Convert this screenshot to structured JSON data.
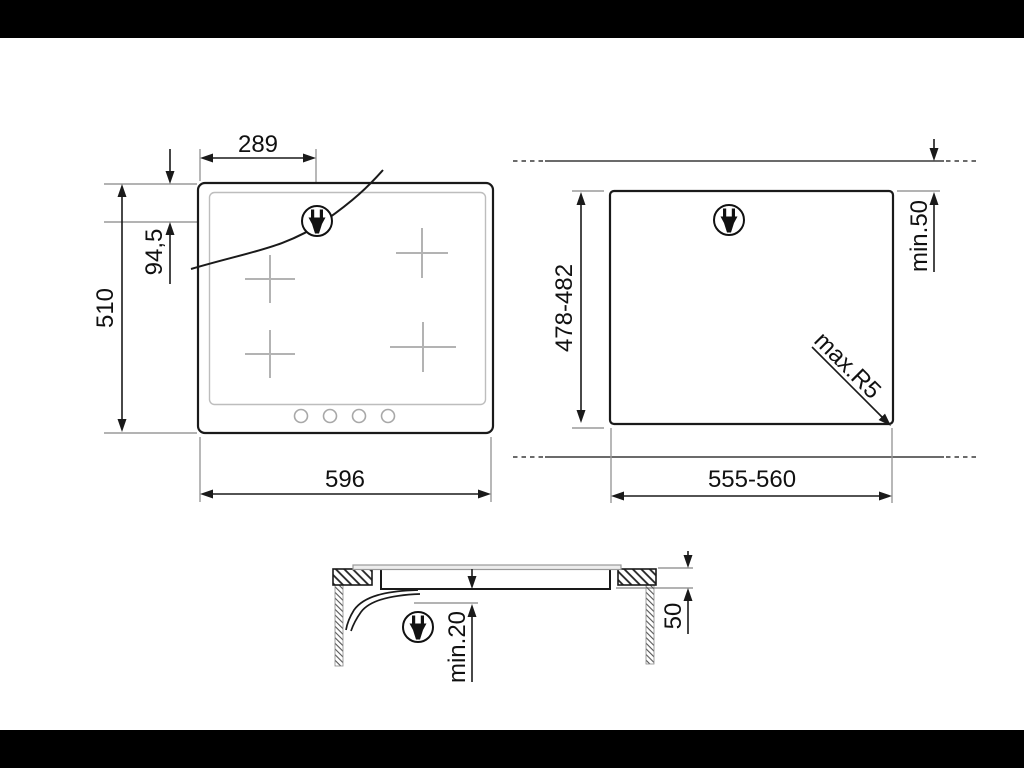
{
  "page": {
    "background": "#ffffff",
    "letterbox_color": "#000000",
    "line_color": "#1a1a1a",
    "extension_line_color": "#9a9a9a",
    "detail_line_color": "#b3b3b3"
  },
  "diagram": {
    "hob_top_view": {
      "width_label": "596",
      "height_label": "510",
      "plug_offset_x_label": "289",
      "plug_offset_y_label": "94,5"
    },
    "cutout_view": {
      "width_label": "555-560",
      "depth_label": "478-482",
      "edge_clearance_label": "min.50",
      "corner_radius_label": "max.R5"
    },
    "section_view": {
      "clearance_below_label": "min.20",
      "recess_depth_label": "50"
    },
    "icons": {
      "power_plug": "power-plug-icon"
    }
  }
}
